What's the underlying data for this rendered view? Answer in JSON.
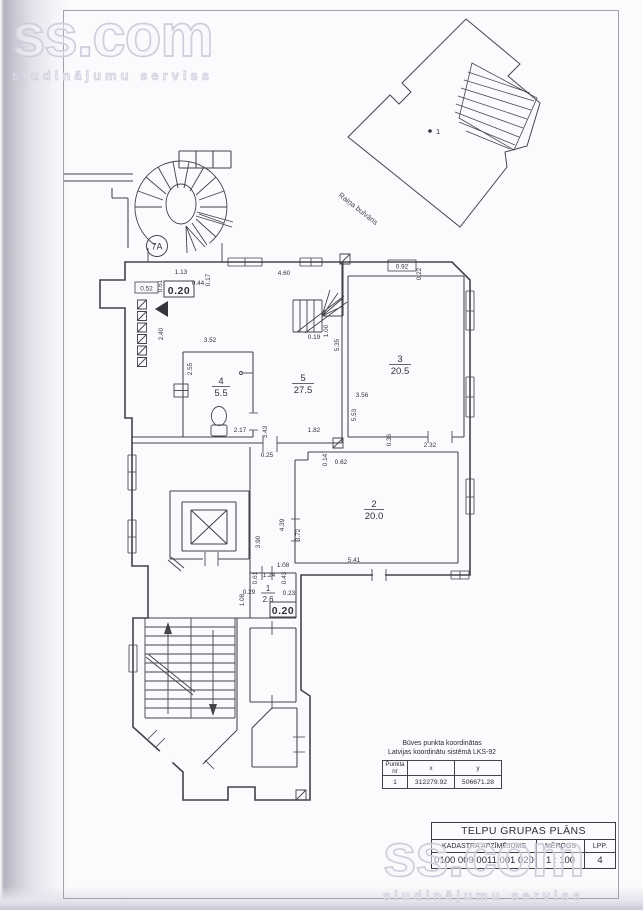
{
  "watermark": {
    "brand": "ss.com",
    "tagline": "sludinājumu serviss"
  },
  "site_plan": {
    "point_label": "1",
    "street_label": "Raiņa bulvāris"
  },
  "floor_plan": {
    "stair_badge": "7A",
    "rooms": [
      {
        "number": "1",
        "area": "2.6"
      },
      {
        "number": "2",
        "area": "20.0"
      },
      {
        "number": "3",
        "area": "20.5"
      },
      {
        "number": "4",
        "area": "5.5"
      },
      {
        "number": "5",
        "area": "27.5"
      }
    ],
    "dims": [
      "0.52",
      "0.61",
      "1.13",
      "0.44",
      "0.17",
      "0.20",
      "4.60",
      "2.40",
      "3.52",
      "2.55",
      "2.17",
      "3.43",
      "0.25",
      "1.82",
      "0.19",
      "1.00",
      "5.35",
      "0.92",
      "0.22",
      "3.56",
      "5.53",
      "0.36",
      "2.32",
      "0.14",
      "0.62",
      "4.39",
      "3.72",
      "3.90",
      "5.41",
      "1.08",
      "1.24",
      "0.61",
      "0.43",
      "0.29",
      "0.23",
      "1.08",
      "0.20"
    ]
  },
  "coords_table": {
    "title_line1": "Būves punkta koordinātas",
    "title_line2": "Latvijas koordinātu sistēmā LKS-92",
    "headers": {
      "point": "Punkta nr",
      "x": "x",
      "y": "y"
    },
    "row": {
      "point": "1",
      "x": "312279.92",
      "y": "506671.28"
    }
  },
  "title_block": {
    "title": "TELPU GRUPAS PLĀNS",
    "cadastre_label": "KADASTRA APZĪMĒJUMS",
    "cadastre_value": "0100 009 0011 001 020",
    "scale_label": "MĒROGS",
    "scale_value": "1 : 100",
    "page_label": "LPP.",
    "page_value": "4"
  }
}
